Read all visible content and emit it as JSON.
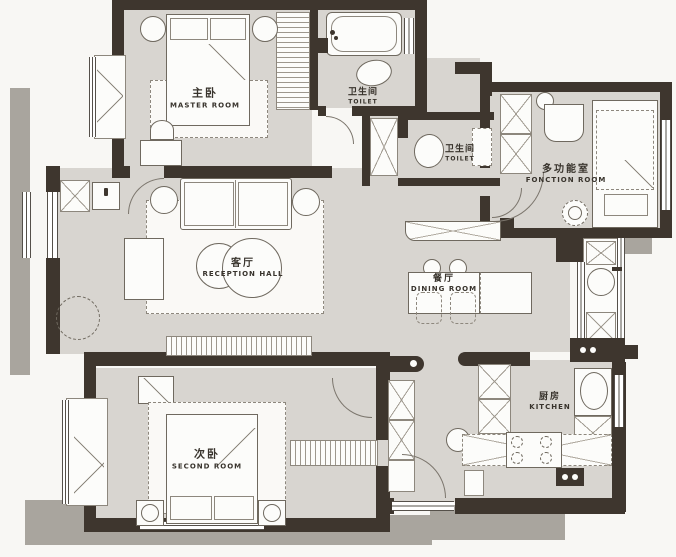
{
  "plan_title": "apartment-floor-plan",
  "palette": {
    "wall": "#3e362e",
    "floor": "#d8d5d0",
    "room_white": "#fcfcfa",
    "paper": "#f8f7f4",
    "shadow": "#a9a59e",
    "outline": "#6f695f",
    "text": "#38332c"
  },
  "rooms": {
    "master_room": {
      "label_zh": "主卧",
      "label_en": "MASTER ROOM"
    },
    "toilet_top": {
      "label_zh": "卫生间",
      "label_en": "TOILET"
    },
    "toilet_mid": {
      "label_zh": "卫生间",
      "label_en": "TOILET"
    },
    "function_room": {
      "label_zh": "多功能室",
      "label_en": "FONCTION ROOM"
    },
    "reception_hall": {
      "label_zh": "客厅",
      "label_en": "RECEPTION HALL"
    },
    "dining_room": {
      "label_zh": "餐厅",
      "label_en": "DINING ROOM"
    },
    "second_room": {
      "label_zh": "次卧",
      "label_en": "SECOND ROOM"
    },
    "kitchen": {
      "label_zh": "厨房",
      "label_en": "KITCHEN"
    }
  }
}
